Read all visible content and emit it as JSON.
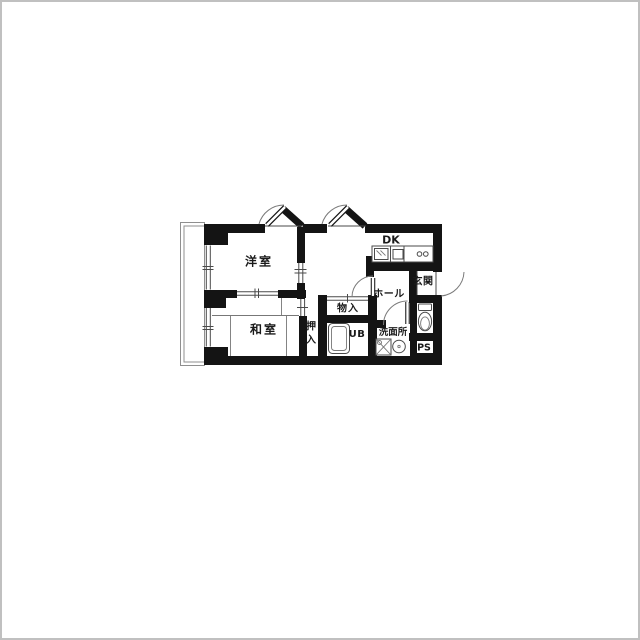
{
  "title": "apartment-floor-plan",
  "colors": {
    "background": "#ffffff",
    "wall": "#141414",
    "thin_line": "#4a4a4a",
    "light_line": "#8f8f8f",
    "text": "#1a1a1a",
    "frame": "#c0c0c0"
  },
  "rooms": {
    "western_room": {
      "label": "洋室"
    },
    "dining_kitchen": {
      "label": "DK"
    },
    "entrance": {
      "label": "玄関"
    },
    "hall": {
      "label": "ホール"
    },
    "storage": {
      "label": "物入"
    },
    "japanese_room": {
      "label": "和室"
    },
    "closet": {
      "label": "押入",
      "char_top": "押",
      "char_bottom": "入"
    },
    "unit_bath": {
      "label": "UB"
    },
    "washroom": {
      "label": "洗面所"
    },
    "pipe_space": {
      "label": "PS"
    }
  },
  "fixtures": [
    "kitchen-sink",
    "stove-burners",
    "bathtub",
    "toilet",
    "washbasin",
    "washing-machine"
  ],
  "features": {
    "balcony": true,
    "tatami_lines": true,
    "door_arcs": 5
  }
}
